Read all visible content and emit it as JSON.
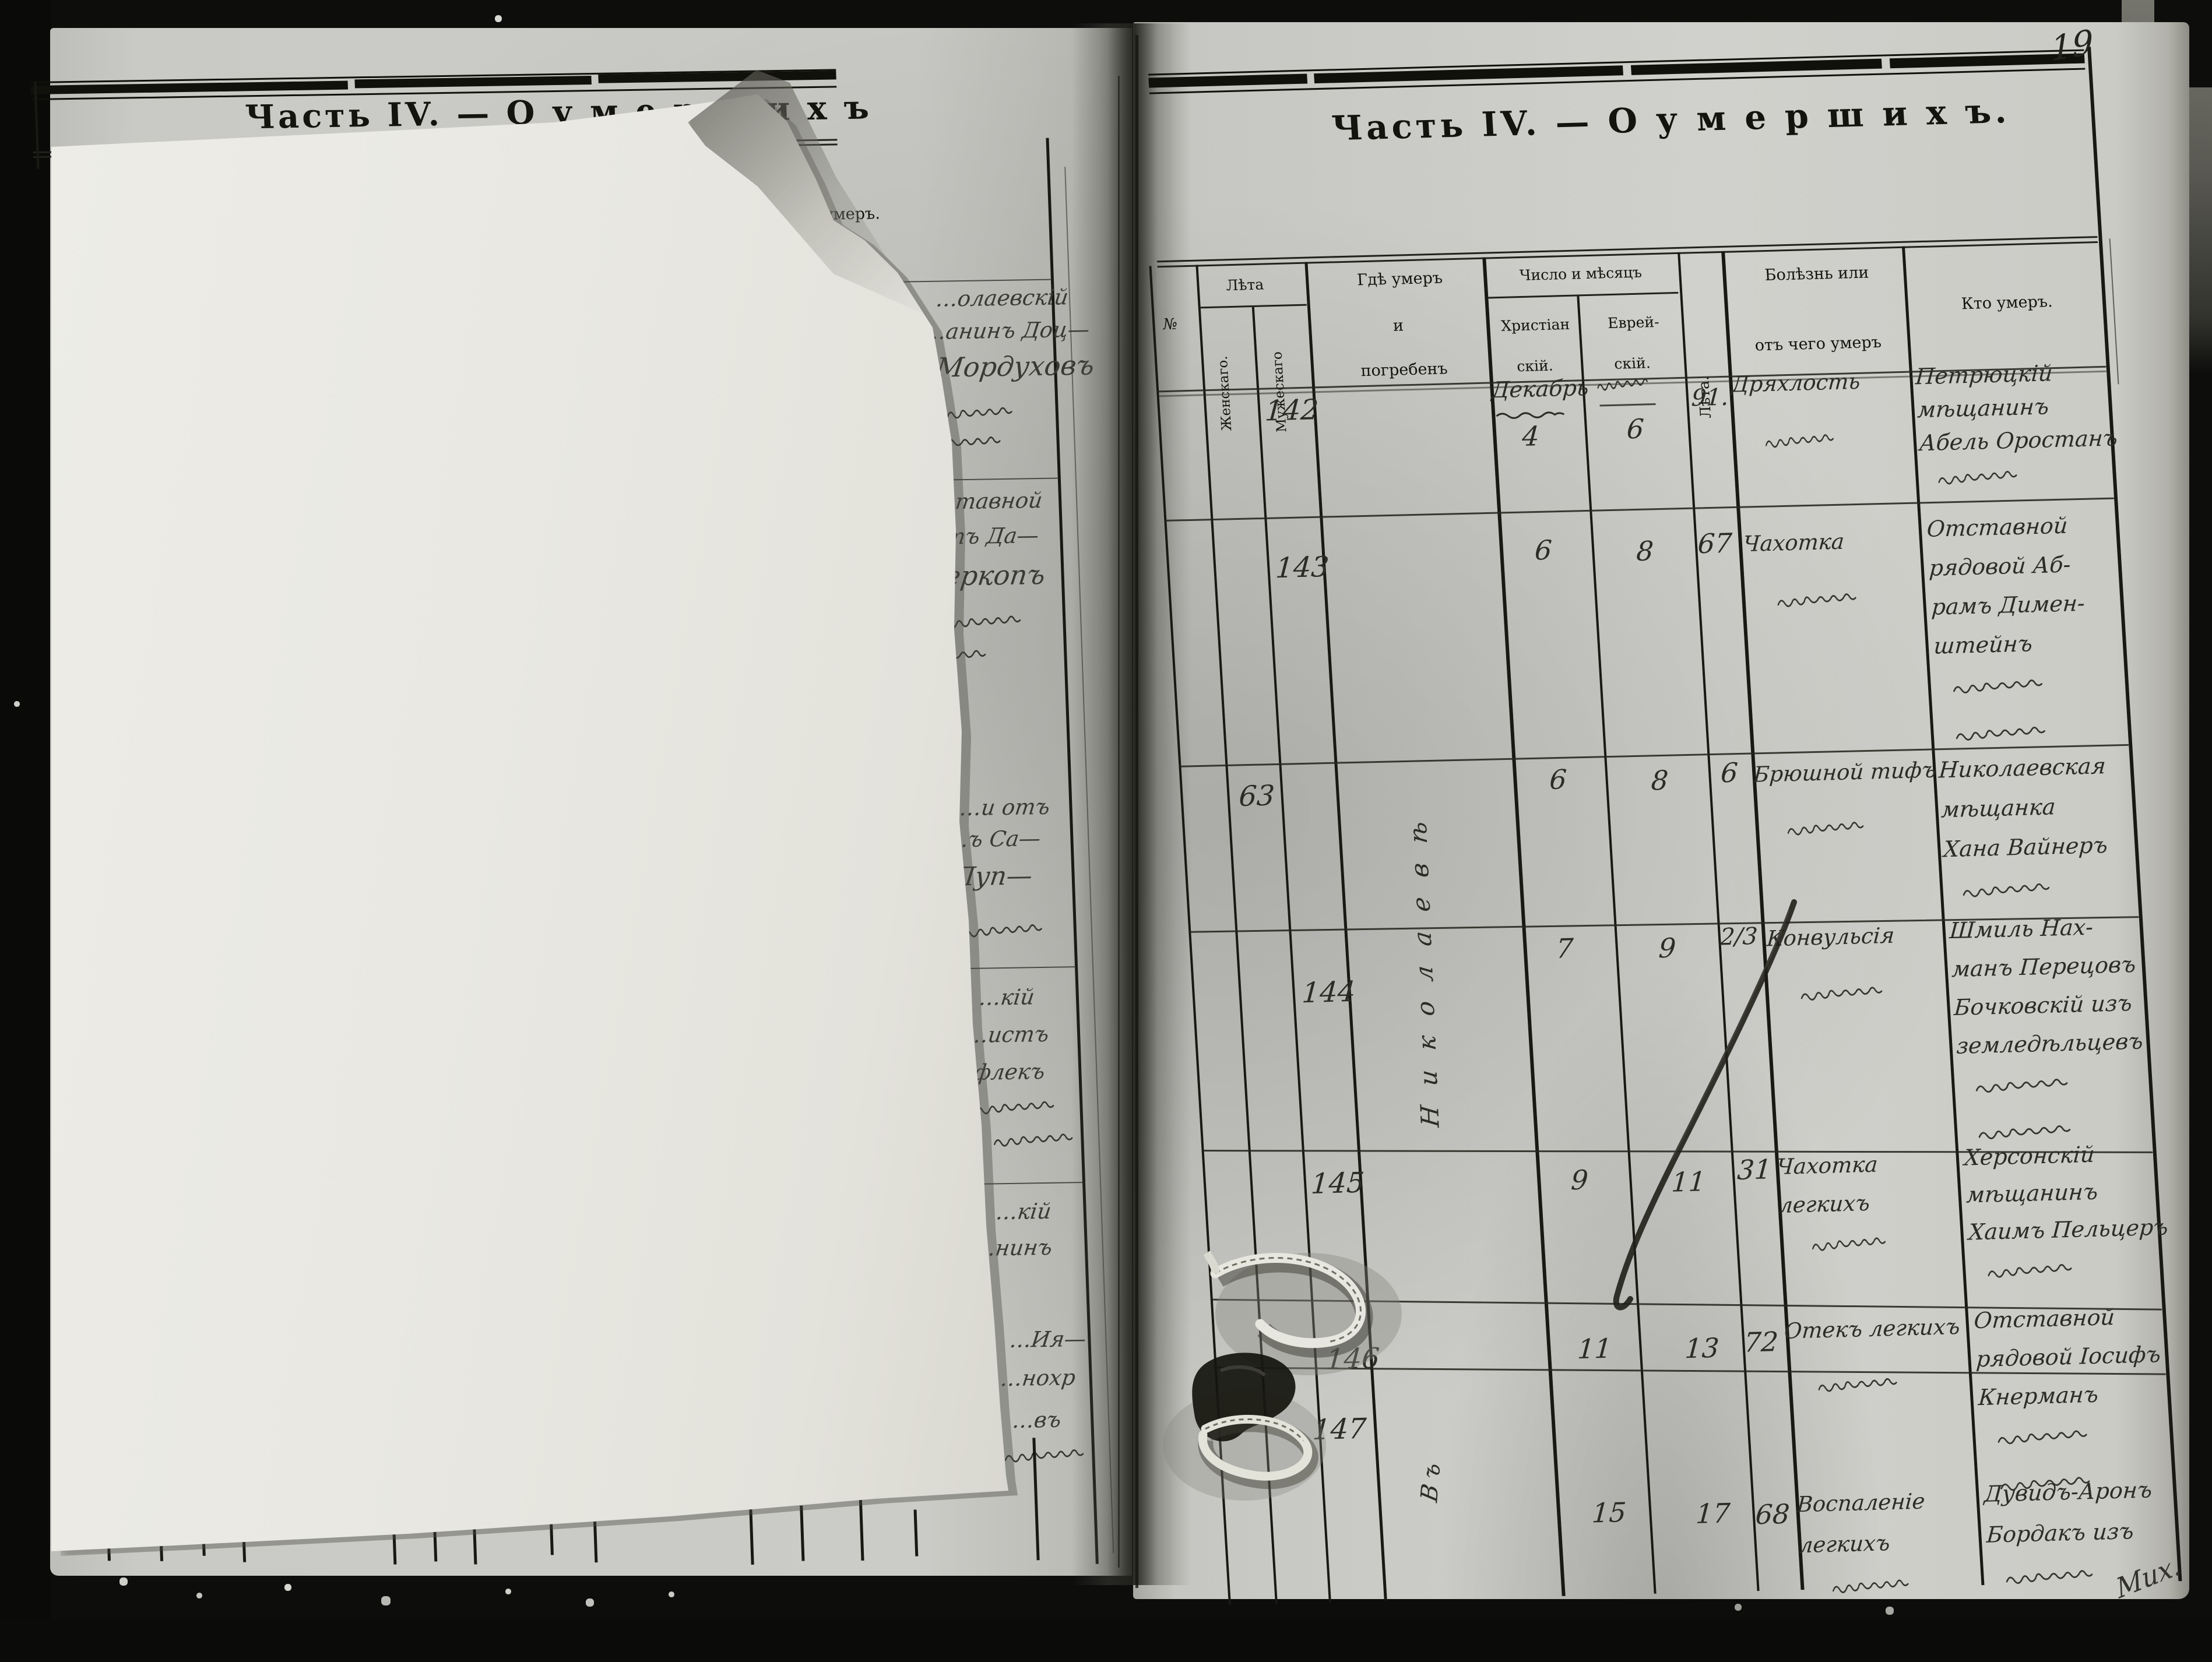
{
  "document": {
    "type": "metrical-book-death-register-scan",
    "page_number": "19",
    "ink_color": "#23231e",
    "paper_color": "#cecec9",
    "sheet_color": "#eceae4"
  },
  "right_page": {
    "title": "Часть IV. — О  у м е р ш и х ъ.",
    "header": {
      "no": "№",
      "years_group": "Лѣта",
      "female": "Женскаго.",
      "male": "Мужескаго",
      "where_line1": "Гдѣ умеръ",
      "where_line2": "и",
      "where_line3": "погребенъ",
      "date_group": "Число и мѣсяцъ",
      "christian_line1": "Христіан",
      "christian_line2": "скій.",
      "jewish_line1": "Еврей-",
      "jewish_line2": "скій.",
      "age": "Лѣта.",
      "illness_line1": "Болѣзнь или",
      "illness_line2": "отъ чего умеръ",
      "who": "Кто умеръ."
    },
    "month_note": "Декабрь",
    "where_vertical_note": "Николаевѣ",
    "where_vertical_note2": "Въ",
    "signature": "Мих.",
    "rows": [
      {
        "num": "142",
        "gender": "m",
        "christian_day": "4",
        "jewish_day": "6",
        "age": "91.",
        "illness": [
          {
            "text": "Дряхлость"
          },
          {
            "hebrew": true
          }
        ],
        "who": [
          {
            "text": "Петрюцкій"
          },
          {
            "text": "мѣщанинъ"
          },
          {
            "text": "Абель Оростанъ"
          },
          {
            "hebrew": true
          }
        ]
      },
      {
        "num": "143",
        "gender": "m",
        "christian_day": "6",
        "jewish_day": "8",
        "age": "67",
        "illness": [
          {
            "text": "Чахотка"
          },
          {
            "hebrew": true
          }
        ],
        "who": [
          {
            "text": "Отставной"
          },
          {
            "text": "рядовой Аб-"
          },
          {
            "text": "рамъ Димен-"
          },
          {
            "text": "штейнъ"
          },
          {
            "hebrew": true
          },
          {
            "hebrew": true
          }
        ]
      },
      {
        "num": "63",
        "gender": "f",
        "christian_day": "6",
        "jewish_day": "8",
        "age": "6",
        "illness": [
          {
            "text": "Брюшной тифъ"
          },
          {
            "hebrew": true
          }
        ],
        "who": [
          {
            "text": "Николаевская"
          },
          {
            "text": "мѣщанка"
          },
          {
            "text": "Хана Вайнеръ"
          },
          {
            "hebrew": true
          }
        ]
      },
      {
        "num": "144",
        "gender": "m",
        "christian_day": "7",
        "jewish_day": "9",
        "age": "2/3",
        "illness": [
          {
            "text": "Конвульсія"
          },
          {
            "hebrew": true
          }
        ],
        "who": [
          {
            "text": "Шмиль Нах-"
          },
          {
            "text": "манъ Перецовъ"
          },
          {
            "text": "Бочковскій изъ"
          },
          {
            "text": "земледѣльцевъ"
          },
          {
            "hebrew": true
          },
          {
            "hebrew": true
          }
        ]
      },
      {
        "num": "145",
        "gender": "m",
        "christian_day": "9",
        "jewish_day": "11",
        "age": "31",
        "illness": [
          {
            "text": "Чахотка"
          },
          {
            "text": "легкихъ"
          },
          {
            "hebrew": true
          }
        ],
        "who": [
          {
            "text": "Херсонскій"
          },
          {
            "text": "мѣщанинъ"
          },
          {
            "text": "Хаимъ Пельцеръ"
          },
          {
            "hebrew": true
          }
        ]
      },
      {
        "num": "146",
        "gender": "m",
        "christian_day": "11",
        "jewish_day": "13",
        "age": "72",
        "illness": [
          {
            "text": "Отекъ легкихъ"
          },
          {
            "hebrew": true
          }
        ],
        "who": [
          {
            "text": "Отставной"
          },
          {
            "text": "рядовой Іосифъ"
          },
          {
            "text": "Кнерманъ"
          },
          {
            "hebrew": true
          },
          {
            "hebrew": true
          }
        ]
      },
      {
        "num": "147",
        "gender": "m",
        "christian_day": "15",
        "jewish_day": "17",
        "age": "68",
        "illness": [
          {
            "text": "Воспаленіе"
          },
          {
            "text": "легкихъ"
          },
          {
            "hebrew": true
          }
        ],
        "who": [
          {
            "text": "Дувидъ-Аронъ"
          },
          {
            "text": "Бордакъ изъ"
          },
          {
            "hebrew": true
          }
        ]
      }
    ]
  },
  "left_page": {
    "title": "Часть IV. — О  у м е р ш и х ъ",
    "header_fragment": "го умеръ.",
    "fragments": [
      {
        "text": "…олаевскій"
      },
      {
        "text": "…анинъ Доц—"
      },
      {
        "text": "Мордуховъ"
      },
      {
        "hebrew": true
      },
      {
        "hebrew": true
      },
      {
        "text": "…тавной"
      },
      {
        "text": "…тъ Да—"
      },
      {
        "text": "Мееркопъ"
      },
      {
        "hebrew": true
      },
      {
        "hebrew": true
      },
      {
        "text": "…и отъ"
      },
      {
        "text": "…ъ Са—"
      },
      {
        "text": "Пуп—"
      },
      {
        "hebrew": true
      },
      {
        "text": "…кій"
      },
      {
        "text": "…истъ"
      },
      {
        "text": "…флекъ"
      },
      {
        "hebrew": true
      },
      {
        "hebrew": true
      },
      {
        "text": "…кій"
      },
      {
        "text": "…нинъ"
      },
      {
        "text": "…Ия—"
      },
      {
        "text": "…нохр"
      },
      {
        "text": "…въ"
      },
      {
        "hebrew": true
      }
    ]
  }
}
